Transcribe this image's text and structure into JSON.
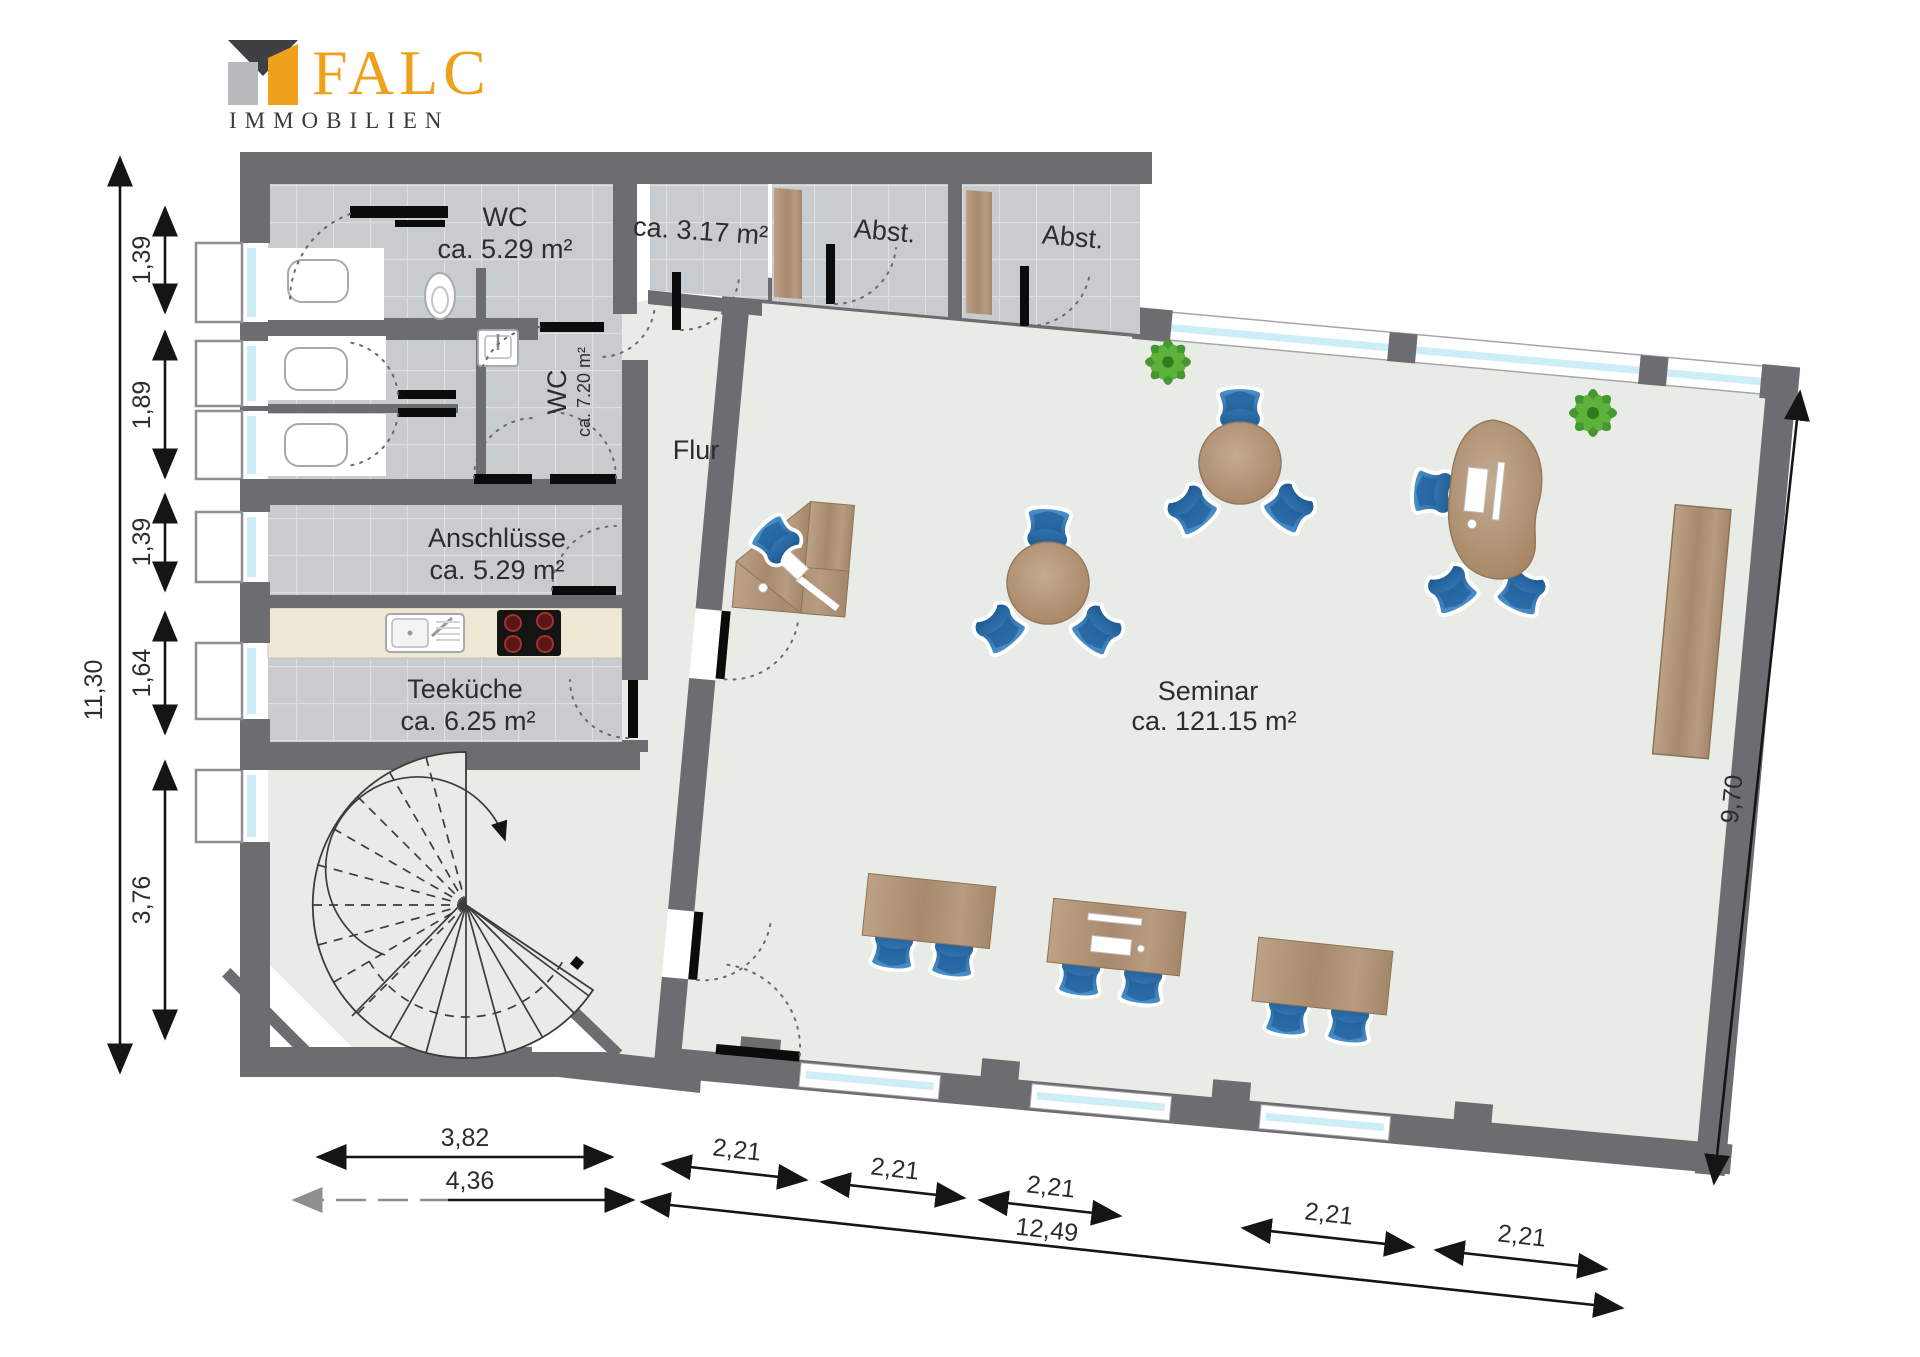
{
  "logo": {
    "brand": "FALC",
    "subtitle": "IMMOBILIEN"
  },
  "rooms": {
    "wc_top": {
      "name": "WC",
      "area": "ca. 5.29 m²"
    },
    "storage_small": {
      "area": "ca. 3.17 m²"
    },
    "abst_1": {
      "name": "Abst."
    },
    "abst_2": {
      "name": "Abst."
    },
    "wc_mid": {
      "name": "WC",
      "area": "ca. 7.20 m²"
    },
    "flur": {
      "name": "Flur"
    },
    "anschluesse": {
      "name": "Anschlüsse",
      "area": "ca. 5.29 m²"
    },
    "teekueche": {
      "name": "Teeküche",
      "area": "ca. 6.25 m²"
    },
    "seminar": {
      "name": "Seminar",
      "area": "ca. 121.15 m²"
    }
  },
  "dimensions": {
    "left_total": "11,30",
    "left_segments": [
      "1,39",
      "1,89",
      "1,39",
      "1,64",
      "3,76"
    ],
    "right_total": "9,70",
    "bottom_left_inner": "3,82",
    "bottom_left_outer": "4,36",
    "bottom_segments": [
      "2,21",
      "2,21",
      "2,21",
      "2,21",
      "2,21"
    ],
    "bottom_total": "12,49"
  },
  "colors": {
    "wall": "#6d6d71",
    "tile": "#c9ccce",
    "seminar_floor": "#e9ece6",
    "wood": "#ab8e74",
    "chair_blue": "#2e76b5",
    "window_glass": "#cdeef6",
    "kitchen_counter": "#efe8d4",
    "logo_orange": "#EFA11B",
    "logo_dark": "#3b3b3d"
  }
}
